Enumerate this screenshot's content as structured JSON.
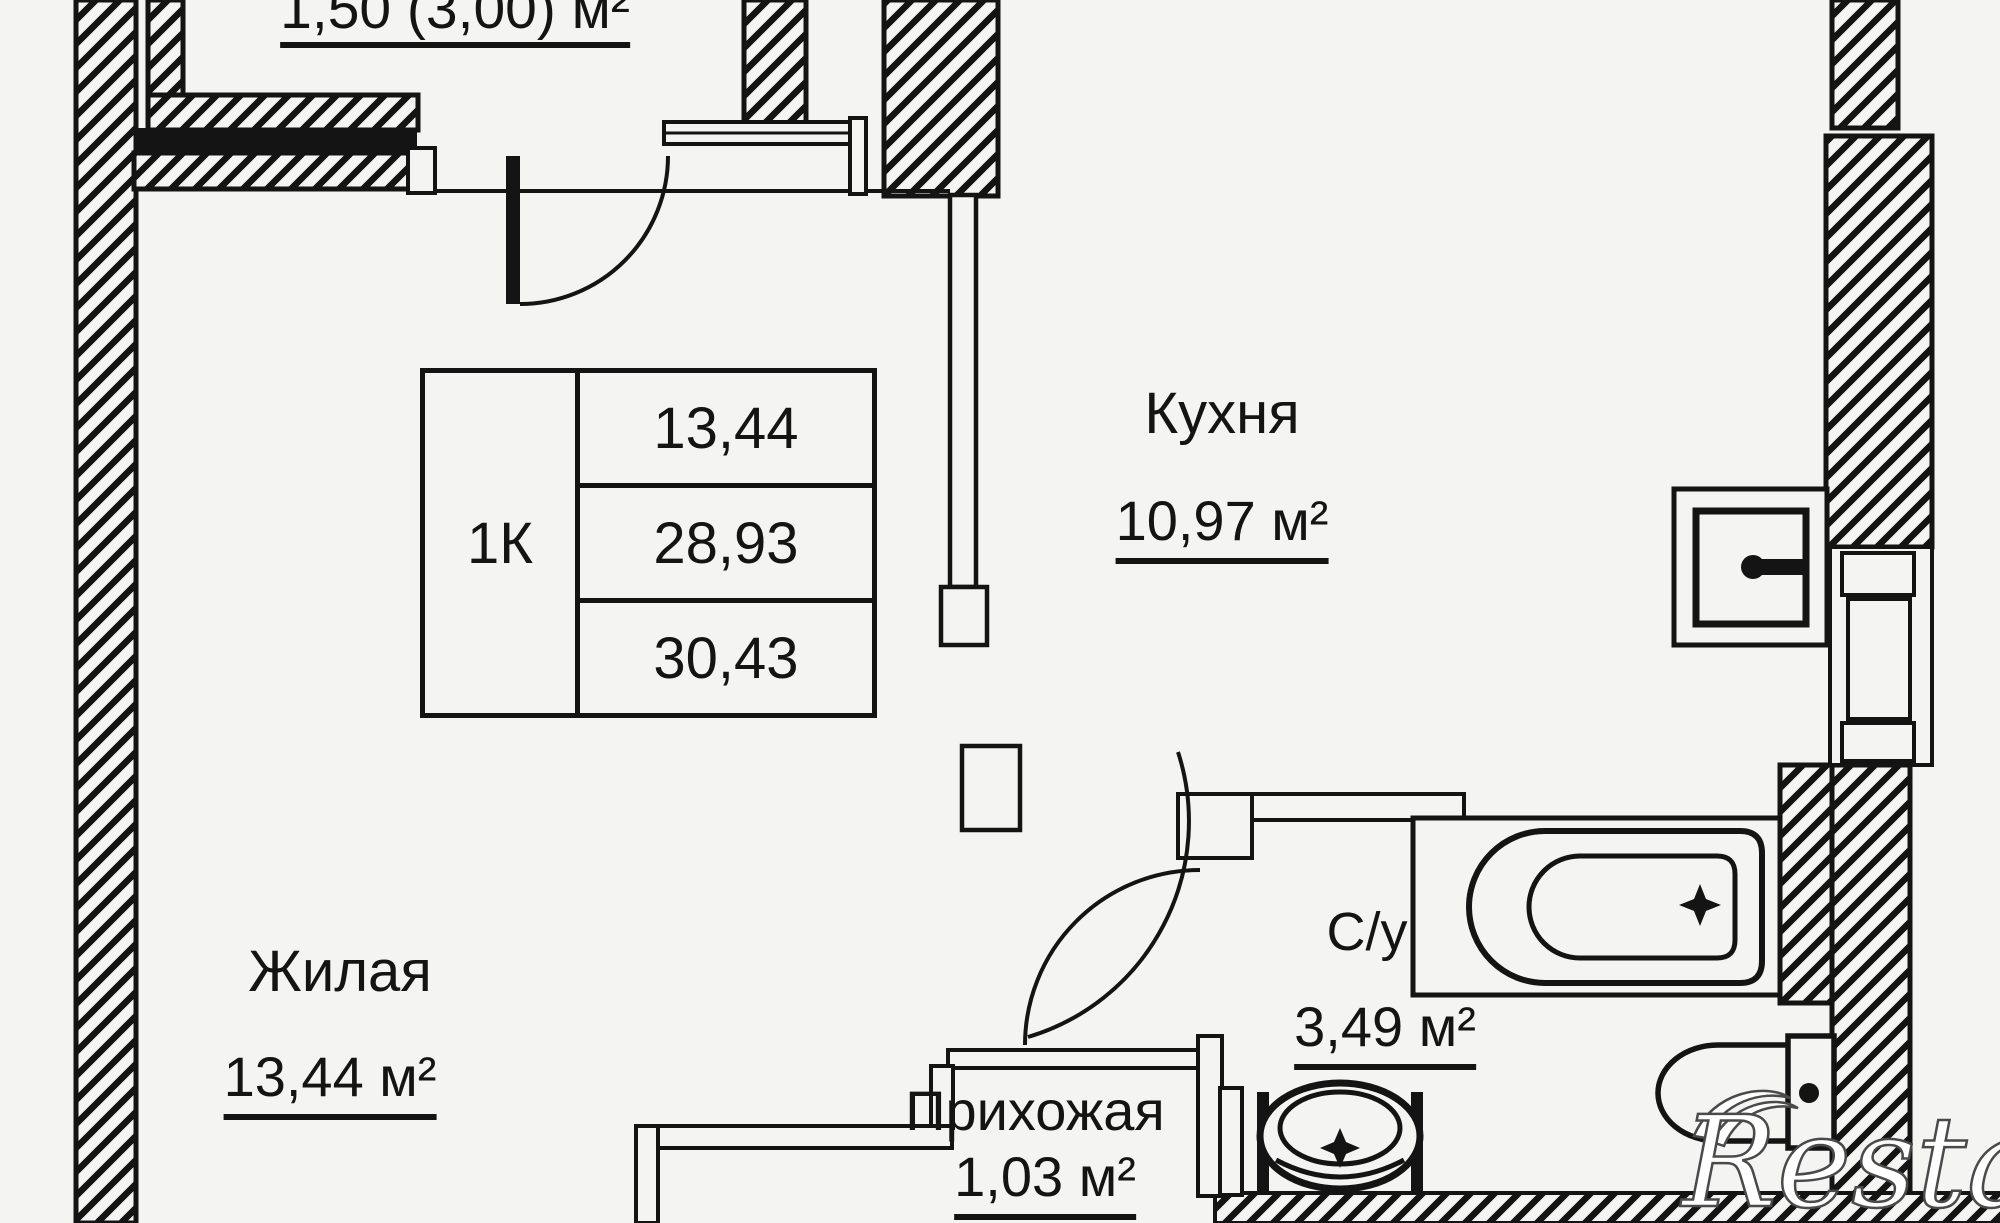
{
  "plan": {
    "balcony": {
      "area_label": "1,50 (3,00) м²"
    },
    "kitchen": {
      "name": "Кухня",
      "area": "10,97 м²"
    },
    "living": {
      "name": "Жилая",
      "area": "13,44 м²"
    },
    "hallway": {
      "name": "Прихожая",
      "area": "1,03 м²"
    },
    "bathroom": {
      "name": "С/у",
      "area": "3,49 м²"
    }
  },
  "info_table": {
    "type_label": "1К",
    "rows": [
      "13,44",
      "28,93",
      "30,43"
    ]
  },
  "watermark": {
    "text": "Restate"
  },
  "colors": {
    "background": "#f4f4f2",
    "line": "#141414",
    "watermark_fill": "#ffffff",
    "watermark_outline": "#4a4a4a"
  }
}
